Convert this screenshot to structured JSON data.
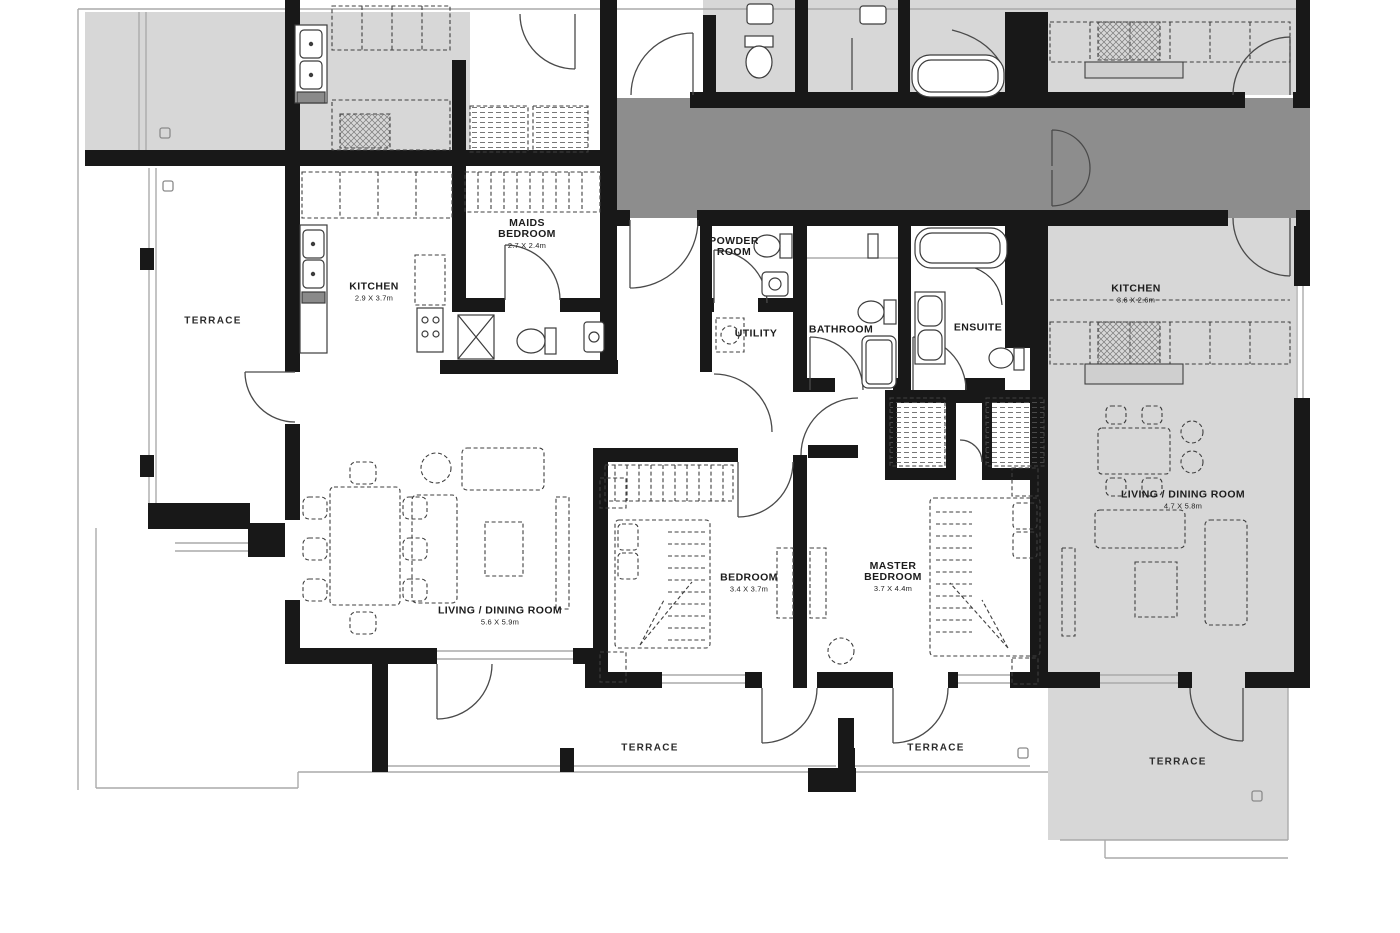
{
  "colors": {
    "wall": "#181818",
    "neighbor_unit_fill": "#d7d7d7",
    "corridor_fill": "#8d8d8d",
    "background": "#ffffff",
    "line": "#3c3c3c"
  },
  "rooms": {
    "terrace_left": {
      "name": "TERRACE"
    },
    "kitchen_left": {
      "name": "KITCHEN",
      "dims": "2.9 X 3.7m"
    },
    "maids_bedroom": {
      "name": "MAIDS BEDROOM",
      "dims": "2.7 X 2.4m"
    },
    "powder_room": {
      "name": "POWDER ROOM"
    },
    "utility": {
      "name": "UTILITY"
    },
    "bathroom": {
      "name": "BATHROOM"
    },
    "ensuite": {
      "name": "ENSUITE"
    },
    "kitchen_right": {
      "name": "KITCHEN",
      "dims": "3.6 X 2.6m"
    },
    "living_dining_center": {
      "name": "LIVING / DINING ROOM",
      "dims": "5.6 X 5.9m"
    },
    "living_dining_right": {
      "name": "LIVING / DINING ROOM",
      "dims": "4.7 X 5.8m"
    },
    "bedroom": {
      "name": "BEDROOM",
      "dims": "3.4 X 3.7m"
    },
    "master_bedroom": {
      "name": "MASTER BEDROOM",
      "dims": "3.7 X 4.4m"
    },
    "terrace_bottom_left": {
      "name": "TERRACE"
    },
    "terrace_bottom_right": {
      "name": "TERRACE"
    },
    "terrace_right_unit": {
      "name": "TERRACE"
    }
  }
}
